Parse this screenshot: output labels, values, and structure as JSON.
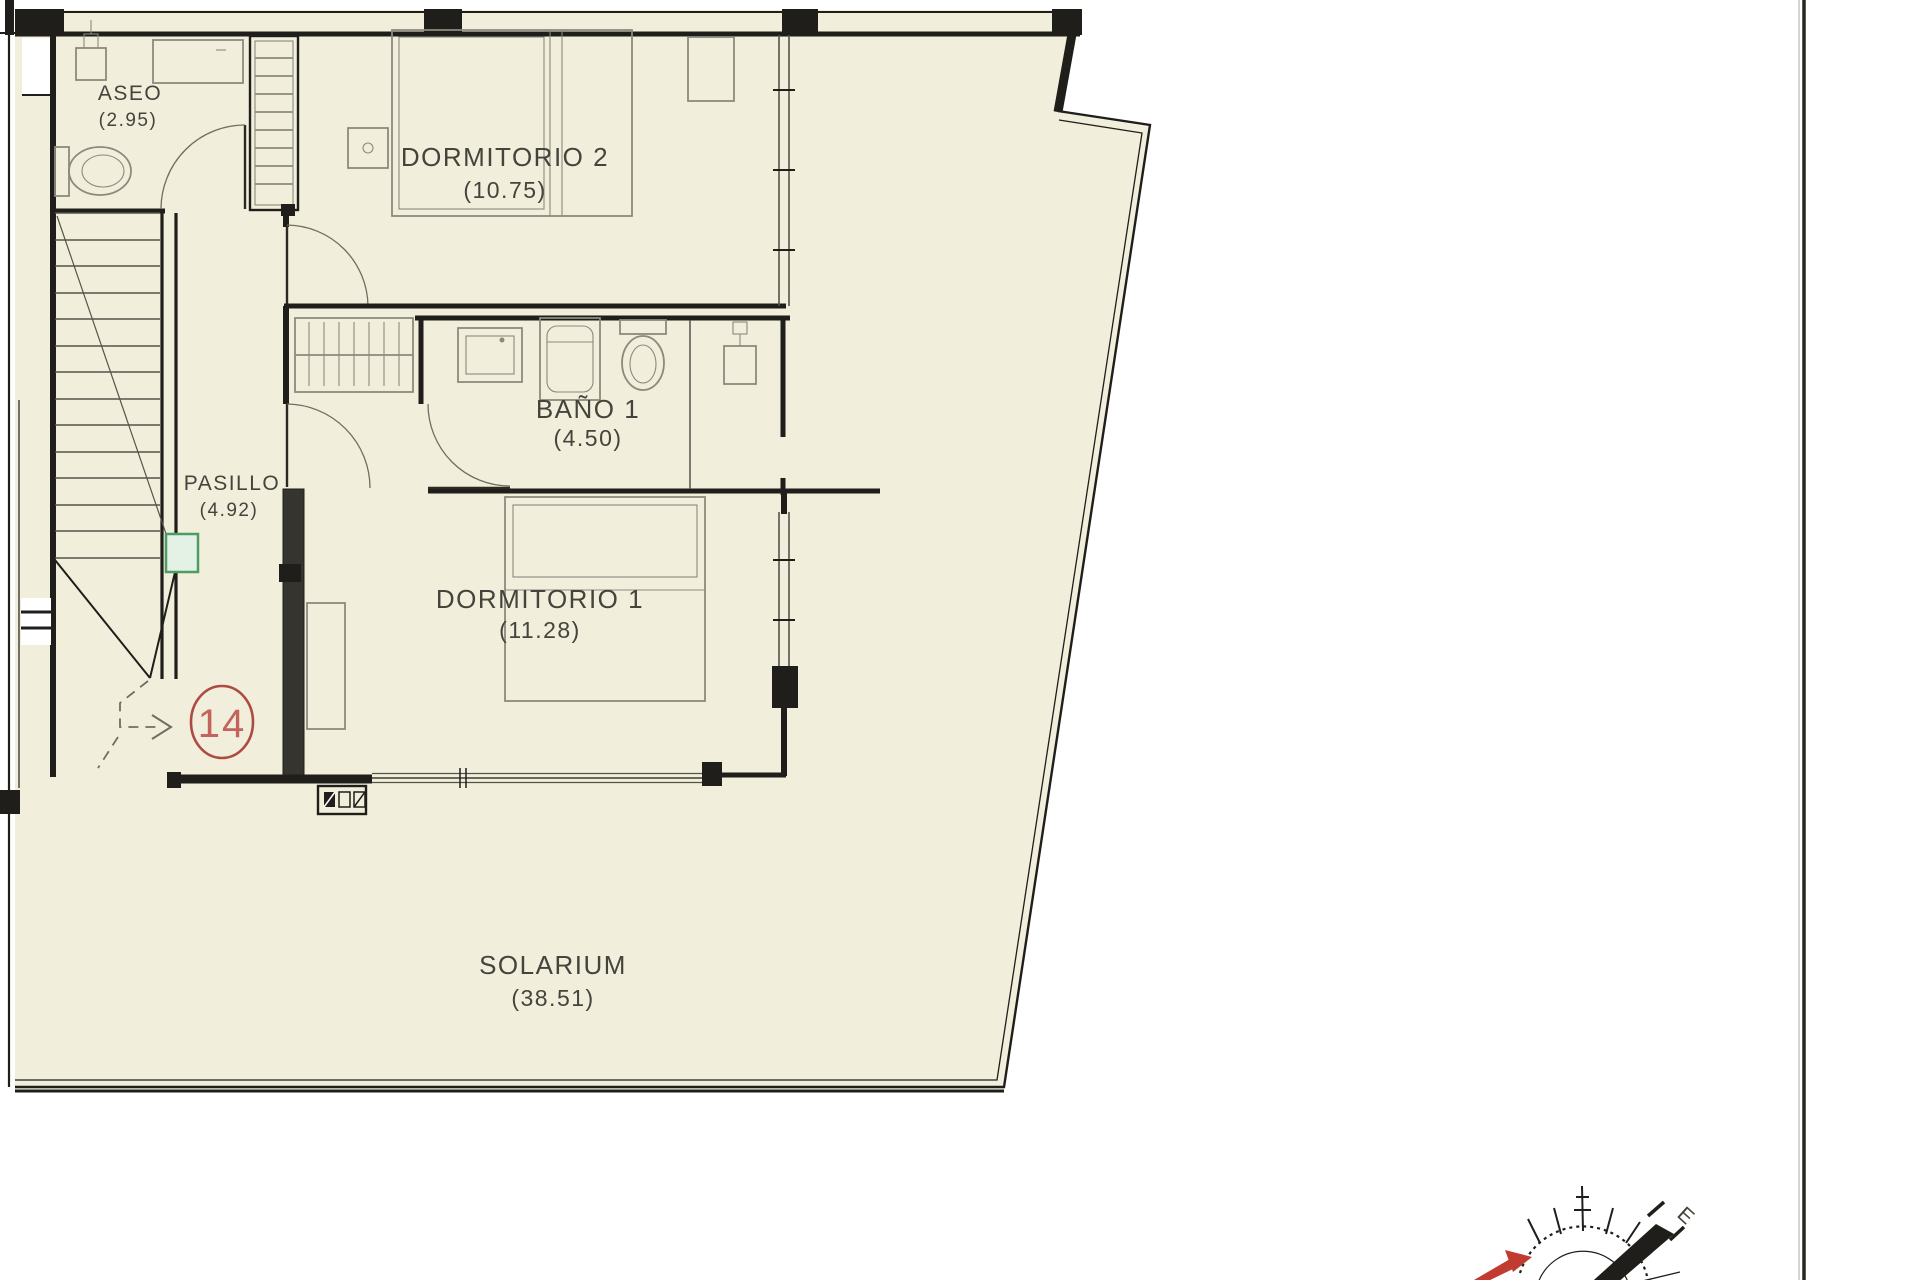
{
  "document": {
    "type": "architectural-floor-plan",
    "floor": "upper floor / solarium level"
  },
  "rooms": [
    {
      "id": "aseo",
      "name": "ASEO",
      "area": "(2.95)"
    },
    {
      "id": "dormitorio2",
      "name": "DORMITORIO 2",
      "area": "(10.75)"
    },
    {
      "id": "bano1",
      "name": "BAÑO 1",
      "area": "(4.50)"
    },
    {
      "id": "pasillo",
      "name": "PASILLO",
      "area": "(4.92)"
    },
    {
      "id": "dormitorio1",
      "name": "DORMITORIO 1",
      "area": "(11.28)"
    },
    {
      "id": "solarium",
      "name": "SOLARIUM",
      "area": "(38.51)"
    }
  ],
  "unit_badge": {
    "number": "14"
  },
  "compass": {
    "east_label": "E"
  },
  "colors": {
    "paper": "#f1eedb",
    "wall": "#1f1e1a",
    "fixture_line": "#8b8a7d",
    "accent_green": "#4d9c62",
    "accent_red": "#ad4b42",
    "badge_text_red": "#c4635b"
  }
}
